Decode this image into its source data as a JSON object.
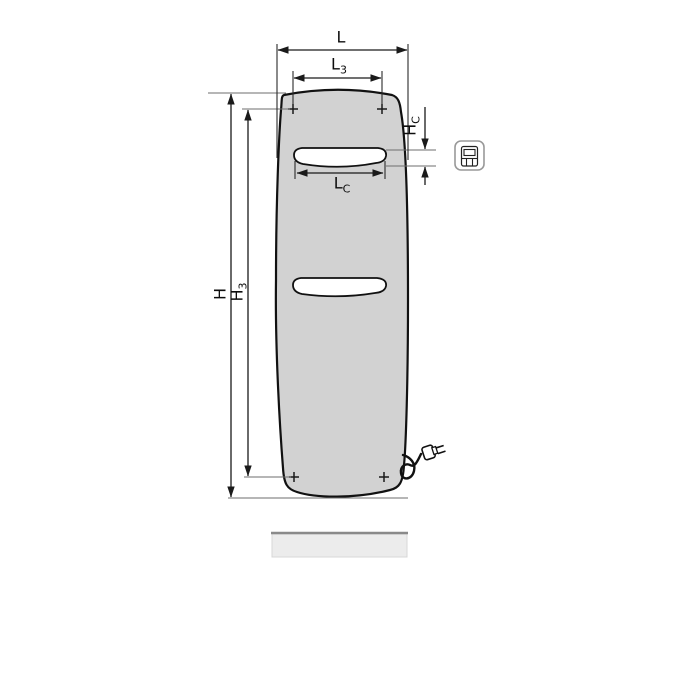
{
  "drawing": {
    "type": "technical-dimension-drawing",
    "subject": "flat panel radiator, front view, with mounting points, grip slots, power cord and floor line",
    "labels": {
      "L": {
        "main": "L",
        "sub": ""
      },
      "L3": {
        "main": "L",
        "sub": "3"
      },
      "LC": {
        "main": "L",
        "sub": "C"
      },
      "H": {
        "main": "H",
        "sub": ""
      },
      "H3": {
        "main": "H",
        "sub": "3"
      },
      "HC": {
        "main": "H",
        "sub": "C"
      }
    },
    "colors": {
      "background": "#ffffff",
      "panel_fill": "#d2d2d2",
      "panel_outline": "#111111",
      "slot_fill": "#ffffff",
      "dimension_line": "#1a1a1a",
      "extension_line": "#6e6e6e",
      "floor_bar_fill": "#ececec",
      "floor_bar_top_edge": "#8a8a8a",
      "icon_border": "#999999"
    },
    "icons": {
      "pictogram": "radiator-front-with-grip-slot-icon",
      "plug": "power-plug-icon"
    },
    "marks": {
      "mounting_points_count": 4,
      "grip_slots_count": 2
    }
  }
}
